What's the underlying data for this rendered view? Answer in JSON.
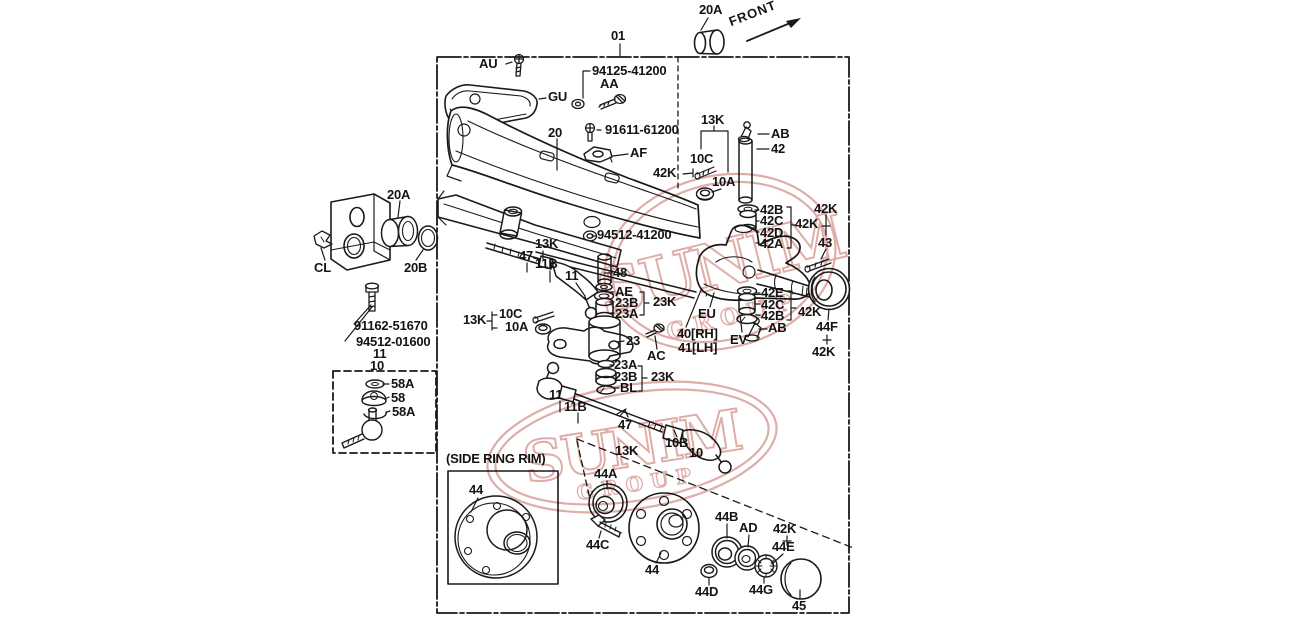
{
  "diagram": {
    "type": "exploded-parts-diagram",
    "subject": "front axle / steering knuckle assembly",
    "ink_color": "#1a1a1a",
    "watermark": {
      "line1": "SUNIM",
      "line2": "GROUP",
      "color": "#cc7b72"
    },
    "labels": [
      {
        "id": "01",
        "t": "01",
        "x": 611,
        "y": 29
      },
      {
        "id": "20a-top",
        "t": "20A",
        "x": 699,
        "y": 3
      },
      {
        "id": "front",
        "t": "FRONT",
        "x": 727,
        "y": 16,
        "r": -21
      },
      {
        "id": "au",
        "t": "AU",
        "x": 479,
        "y": 57
      },
      {
        "id": "pn-94125-41200",
        "t": "94125-41200",
        "x": 592,
        "y": 64
      },
      {
        "id": "aa",
        "t": "AA",
        "x": 600,
        "y": 77
      },
      {
        "id": "gu",
        "t": "GU",
        "x": 548,
        "y": 90
      },
      {
        "id": "20",
        "t": "20",
        "x": 548,
        "y": 126
      },
      {
        "id": "pn-91611-61200",
        "t": "91611-61200",
        "x": 605,
        "y": 123
      },
      {
        "id": "af",
        "t": "AF",
        "x": 630,
        "y": 146
      },
      {
        "id": "13k-top",
        "t": "13K",
        "x": 701,
        "y": 113
      },
      {
        "id": "10c-top",
        "t": "10C",
        "x": 690,
        "y": 152
      },
      {
        "id": "42k-arrow",
        "t": "42K",
        "x": 653,
        "y": 166
      },
      {
        "id": "10a-top",
        "t": "10A",
        "x": 712,
        "y": 175
      },
      {
        "id": "ab-top",
        "t": "AB",
        "x": 771,
        "y": 127
      },
      {
        "id": "42",
        "t": "42",
        "x": 771,
        "y": 142
      },
      {
        "id": "42b-u",
        "t": "42B",
        "x": 760,
        "y": 203
      },
      {
        "id": "42c-u",
        "t": "42C",
        "x": 760,
        "y": 214
      },
      {
        "id": "42d-u",
        "t": "42D",
        "x": 760,
        "y": 226
      },
      {
        "id": "42a-u",
        "t": "42A",
        "x": 760,
        "y": 237
      },
      {
        "id": "42k-stack",
        "t": "42K",
        "x": 795,
        "y": 217
      },
      {
        "id": "42k-tr",
        "t": "42K",
        "x": 814,
        "y": 202
      },
      {
        "id": "43",
        "t": "43",
        "x": 818,
        "y": 236
      },
      {
        "id": "20a-left",
        "t": "20A",
        "x": 387,
        "y": 188
      },
      {
        "id": "cl",
        "t": "CL",
        "x": 314,
        "y": 261
      },
      {
        "id": "20b",
        "t": "20B",
        "x": 404,
        "y": 261
      },
      {
        "id": "pn-91162-51670",
        "t": "91162-51670",
        "x": 354,
        "y": 319
      },
      {
        "id": "pn-94512-01600",
        "t": "94512-01600",
        "x": 356,
        "y": 335
      },
      {
        "id": "11-left",
        "t": "11",
        "x": 373,
        "y": 347
      },
      {
        "id": "10-left",
        "t": "10",
        "x": 370,
        "y": 359
      },
      {
        "id": "58a-1",
        "t": "58A",
        "x": 391,
        "y": 377
      },
      {
        "id": "58",
        "t": "58",
        "x": 391,
        "y": 391
      },
      {
        "id": "58a-2",
        "t": "58A",
        "x": 392,
        "y": 405
      },
      {
        "id": "13k-m",
        "t": "13K",
        "x": 535,
        "y": 237
      },
      {
        "id": "47-u",
        "t": "47",
        "x": 519,
        "y": 249
      },
      {
        "id": "11b-u",
        "t": "11B",
        "x": 535,
        "y": 257
      },
      {
        "id": "11-u",
        "t": "11",
        "x": 565,
        "y": 269
      },
      {
        "id": "13k-l",
        "t": "13K",
        "x": 463,
        "y": 313
      },
      {
        "id": "10c-l",
        "t": "10C",
        "x": 499,
        "y": 307
      },
      {
        "id": "10a-l",
        "t": "10A",
        "x": 505,
        "y": 320
      },
      {
        "id": "pn-94512-41200",
        "t": "94512-41200",
        "x": 597,
        "y": 228
      },
      {
        "id": "48",
        "t": "48",
        "x": 613,
        "y": 266
      },
      {
        "id": "ae",
        "t": "AE",
        "x": 615,
        "y": 285
      },
      {
        "id": "23b-u",
        "t": "23B",
        "x": 615,
        "y": 296
      },
      {
        "id": "23a-u",
        "t": "23A",
        "x": 615,
        "y": 307
      },
      {
        "id": "23k-u",
        "t": "23K",
        "x": 653,
        "y": 295
      },
      {
        "id": "23",
        "t": "23",
        "x": 626,
        "y": 334
      },
      {
        "id": "ac",
        "t": "AC",
        "x": 647,
        "y": 349
      },
      {
        "id": "23a-l",
        "t": "23A",
        "x": 614,
        "y": 358
      },
      {
        "id": "23b-l",
        "t": "23B",
        "x": 614,
        "y": 370
      },
      {
        "id": "bl",
        "t": "BL",
        "x": 620,
        "y": 381
      },
      {
        "id": "23k-l",
        "t": "23K",
        "x": 651,
        "y": 370
      },
      {
        "id": "eu",
        "t": "EU",
        "x": 698,
        "y": 307
      },
      {
        "id": "40rh",
        "t": "40[RH]",
        "x": 677,
        "y": 327
      },
      {
        "id": "41lh",
        "t": "41[LH]",
        "x": 678,
        "y": 341
      },
      {
        "id": "ev",
        "t": "EV",
        "x": 730,
        "y": 333
      },
      {
        "id": "ab-l",
        "t": "AB",
        "x": 768,
        "y": 321
      },
      {
        "id": "42e",
        "t": "42E",
        "x": 761,
        "y": 286
      },
      {
        "id": "42c-2",
        "t": "42C",
        "x": 761,
        "y": 298
      },
      {
        "id": "42b-2",
        "t": "42B",
        "x": 761,
        "y": 309
      },
      {
        "id": "42k-low",
        "t": "42K",
        "x": 798,
        "y": 305
      },
      {
        "id": "44f",
        "t": "44F",
        "x": 816,
        "y": 320
      },
      {
        "id": "42k-44f",
        "t": "42K",
        "x": 812,
        "y": 345
      },
      {
        "id": "11-b",
        "t": "11",
        "x": 549,
        "y": 388
      },
      {
        "id": "11b-b",
        "t": "11B",
        "x": 564,
        "y": 400
      },
      {
        "id": "47-b",
        "t": "47",
        "x": 618,
        "y": 418
      },
      {
        "id": "13k-b",
        "t": "13K",
        "x": 615,
        "y": 444
      },
      {
        "id": "10b",
        "t": "10B",
        "x": 665,
        "y": 436
      },
      {
        "id": "10-b",
        "t": "10",
        "x": 689,
        "y": 446
      },
      {
        "id": "srr",
        "t": "(SIDE RING RIM)",
        "x": 446,
        "y": 452
      },
      {
        "id": "44-box",
        "t": "44",
        "x": 469,
        "y": 483
      },
      {
        "id": "44a",
        "t": "44A",
        "x": 594,
        "y": 467
      },
      {
        "id": "44c",
        "t": "44C",
        "x": 586,
        "y": 538
      },
      {
        "id": "44-hub",
        "t": "44",
        "x": 645,
        "y": 563
      },
      {
        "id": "44b",
        "t": "44B",
        "x": 715,
        "y": 510
      },
      {
        "id": "ad",
        "t": "AD",
        "x": 739,
        "y": 521
      },
      {
        "id": "42k-b",
        "t": "42K",
        "x": 773,
        "y": 522
      },
      {
        "id": "44e",
        "t": "44E",
        "x": 772,
        "y": 540
      },
      {
        "id": "44d",
        "t": "44D",
        "x": 695,
        "y": 585
      },
      {
        "id": "44g",
        "t": "44G",
        "x": 749,
        "y": 583
      },
      {
        "id": "45",
        "t": "45",
        "x": 792,
        "y": 599
      }
    ]
  }
}
